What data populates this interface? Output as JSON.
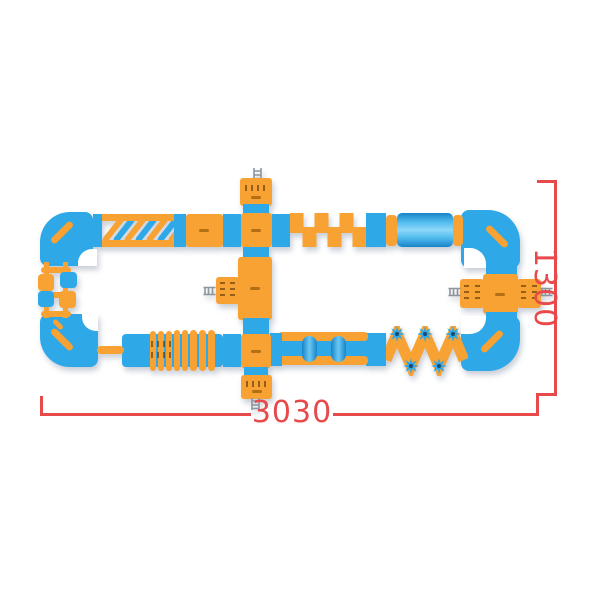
{
  "colors": {
    "blue": "#2FA8E8",
    "blue_dark": "#1E86C9",
    "orange": "#F7A233",
    "orange_dark": "#E08E1F",
    "red": "#E8494A",
    "ladder_grey": "#8D959D"
  },
  "dimension_labels": {
    "width": "3030",
    "height": "1300"
  },
  "diagram": {
    "type": "inflatable-water-park-top-view",
    "components": [
      "top-left-corner",
      "diagonal-bars-obstacle",
      "orange-mat",
      "top-cross-junction",
      "castellated-obstacle",
      "roller-cylinder",
      "top-right-corner",
      "right-junction",
      "right-junction-platforms",
      "bottom-right-corner",
      "spike-zigzag-obstacle",
      "roller-bridge",
      "bottom-junction",
      "accordion-obstacle",
      "bottom-left-corner",
      "stepping-blocks",
      "entry-platform-top",
      "center-platform",
      "entry-platform-bottom"
    ]
  }
}
